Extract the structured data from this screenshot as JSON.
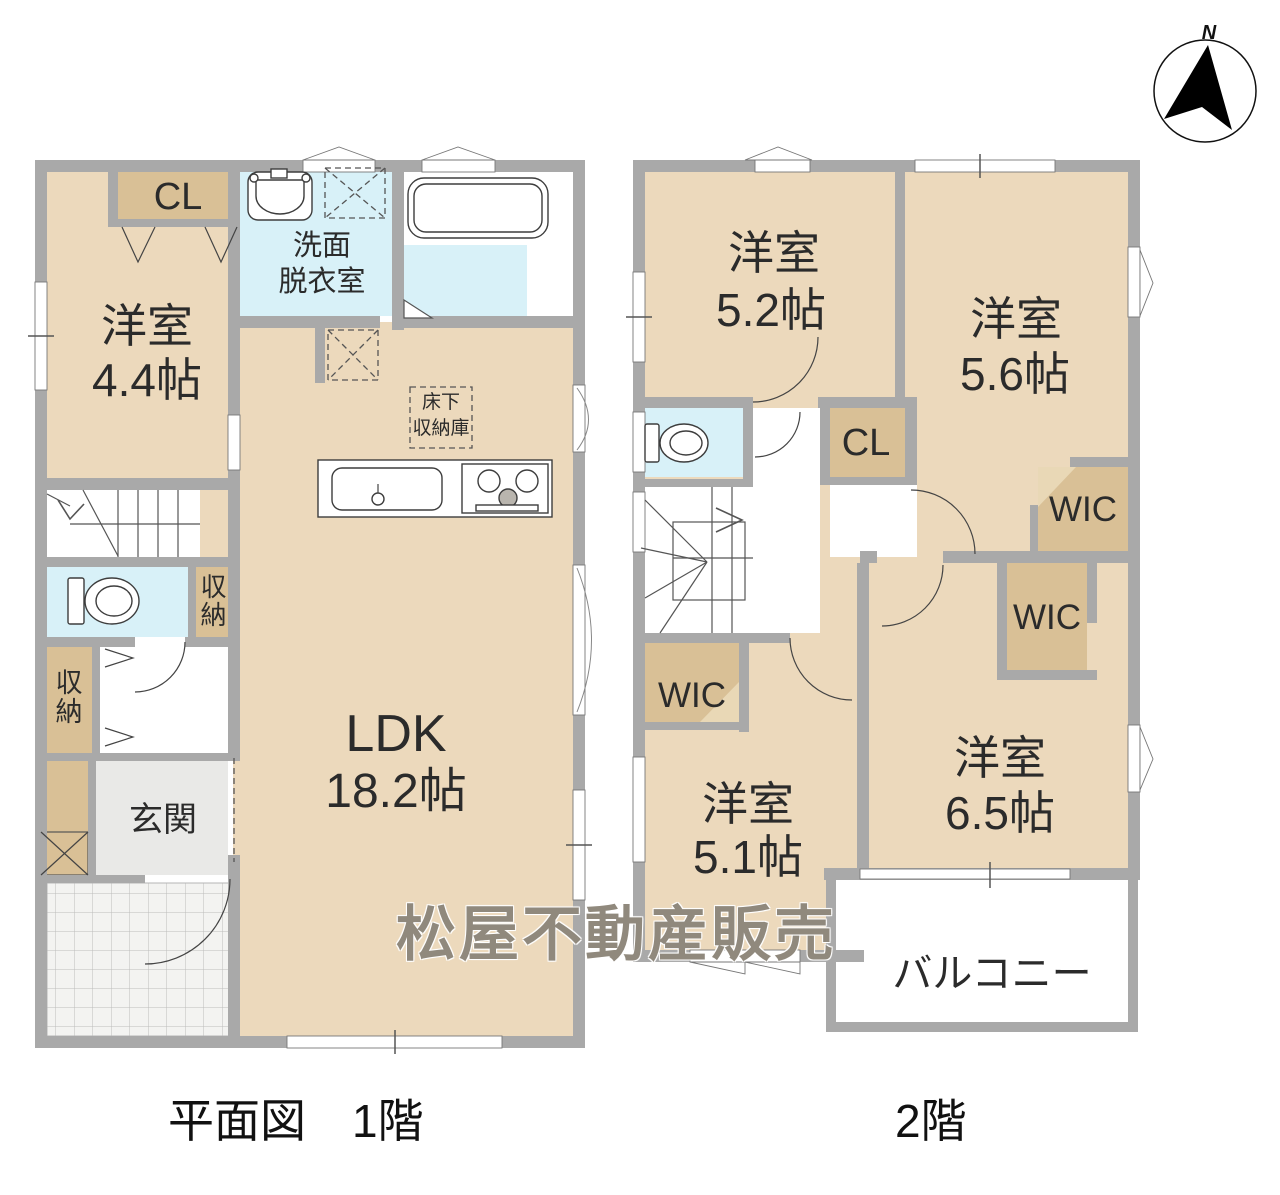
{
  "watermark": "松屋不動産販売",
  "compass": {
    "north_label": "N"
  },
  "captions": {
    "floor1": "平面図　1階",
    "floor2": "2階"
  },
  "colors": {
    "room_beige": "#ecd9bc",
    "closet_beige": "#d9c096",
    "wet_area_blue": "#d8f1f8",
    "wall_gray": "#a9a9a9",
    "entrance_gray": "#e9e9e7"
  },
  "floor1": {
    "rooms": {
      "western_room": {
        "name": "洋室",
        "size": "4.4帖"
      },
      "closet": "CL",
      "washroom": {
        "line1": "洗面",
        "line2": "脱衣室"
      },
      "ldk": {
        "name": "LDK",
        "size": "18.2帖"
      },
      "underfloor_storage": {
        "line1": "床下",
        "line2": "収納庫"
      },
      "storage_by_toilet": "収納",
      "storage_by_hall": "収納",
      "entrance": "玄関"
    }
  },
  "floor2": {
    "rooms": {
      "western_room_52": {
        "name": "洋室",
        "size": "5.2帖"
      },
      "western_room_56": {
        "name": "洋室",
        "size": "5.6帖"
      },
      "western_room_65": {
        "name": "洋室",
        "size": "6.5帖"
      },
      "western_room_51": {
        "name": "洋室",
        "size": "5.1帖"
      },
      "closet": "CL",
      "wic_upper": "WIC",
      "wic_middle": "WIC",
      "wic_lower": "WIC",
      "balcony": "バルコニー"
    }
  }
}
